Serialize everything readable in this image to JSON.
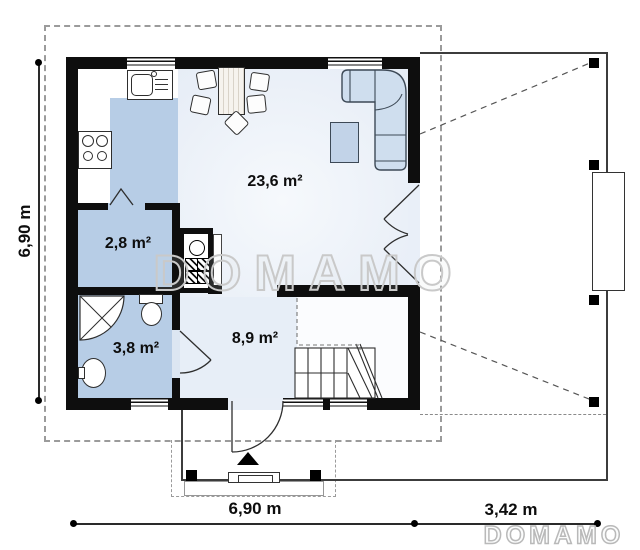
{
  "watermark": {
    "text": "DOMAMO"
  },
  "brand": {
    "text": "DOMAMO"
  },
  "rooms": {
    "living": {
      "name": "living-room-with-kitchen",
      "area": "23,6 m²"
    },
    "storage": {
      "name": "storage-room",
      "area": "2,8 m²"
    },
    "bathroom": {
      "name": "bathroom",
      "area": "3,8 m²"
    },
    "hall": {
      "name": "hall-with-stairs",
      "area": "8,9 m²"
    }
  },
  "dimensions": {
    "left": "6,90 m",
    "bottom": "6,90 m",
    "terrace": "3,42 m"
  },
  "fixtures": [
    "kitchen-sink",
    "cooktop",
    "dining-table",
    "chair",
    "corner-sofa",
    "coffee-table",
    "chimney",
    "shower",
    "toilet",
    "washbasin",
    "stairs",
    "entrance-arrow",
    "terrace-post"
  ],
  "colors": {
    "wall": "#0e0e0e",
    "room_fill": "#b7cde6",
    "floor_fill": "#e8eef7",
    "furniture_fill": "#cfdeee",
    "dash": "#9b9b9b"
  }
}
